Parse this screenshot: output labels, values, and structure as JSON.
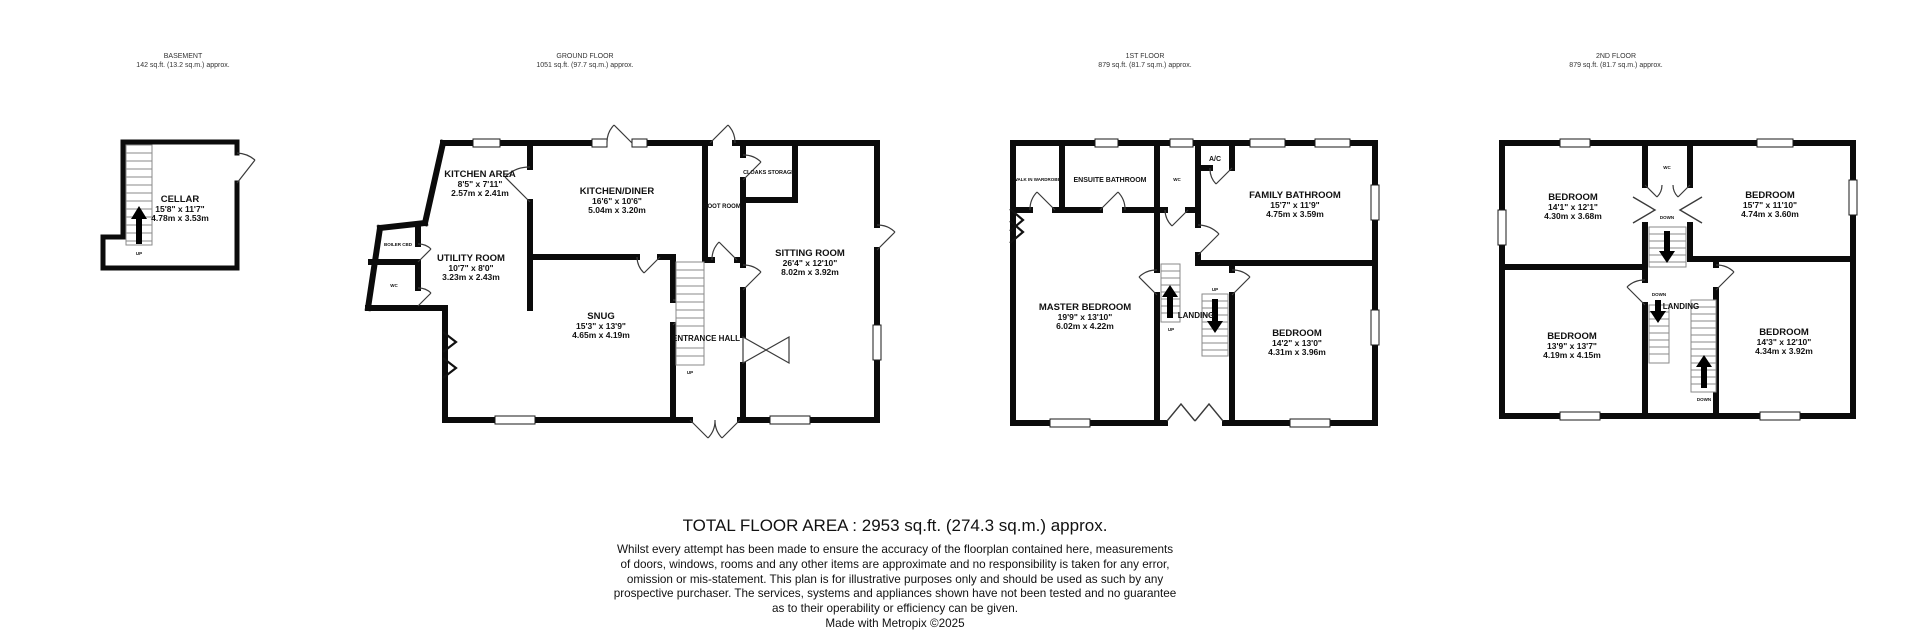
{
  "colors": {
    "walls": "#0b0b0b",
    "text": "#111111",
    "background": "#ffffff"
  },
  "floors": {
    "basement": {
      "label": "BASEMENT",
      "area": "142 sq.ft. (13.2 sq.m.) approx.",
      "rooms": {
        "cellar": {
          "name": "CELLAR",
          "imperial": "15'8\" x 11'7\"",
          "metric": "4.78m x 3.53m"
        }
      },
      "labels": {
        "up": "UP"
      }
    },
    "ground": {
      "label": "GROUND FLOOR",
      "area": "1051 sq.ft. (97.7 sq.m.) approx.",
      "rooms": {
        "kitchen_area": {
          "name": "KITCHEN AREA",
          "imperial": "8'5\" x 7'11\"",
          "metric": "2.57m x 2.41m"
        },
        "kitchen_diner": {
          "name": "KITCHEN/DINER",
          "imperial": "16'6\" x 10'6\"",
          "metric": "5.04m x 3.20m"
        },
        "utility": {
          "name": "UTILITY ROOM",
          "imperial": "10'7\" x 8'0\"",
          "metric": "3.23m x 2.43m"
        },
        "snug": {
          "name": "SNUG",
          "imperial": "15'3\" x 13'9\"",
          "metric": "4.65m x 4.19m"
        },
        "sitting": {
          "name": "SITTING ROOM",
          "imperial": "26'4\" x 12'10\"",
          "metric": "8.02m x 3.92m"
        }
      },
      "labels": {
        "boiler": "BOILER CBD",
        "wc": "WC",
        "boot": "BOOT ROOM",
        "cloaks": "CLOAKS STORAGE",
        "hall": "ENTRANCE HALL",
        "up": "UP"
      }
    },
    "first": {
      "label": "1ST FLOOR",
      "area": "879 sq.ft. (81.7 sq.m.) approx.",
      "rooms": {
        "family_bath": {
          "name": "FAMILY BATHROOM",
          "imperial": "15'7\" x 11'9\"",
          "metric": "4.75m x 3.59m"
        },
        "master": {
          "name": "MASTER BEDROOM",
          "imperial": "19'9\" x 13'10\"",
          "metric": "6.02m x 4.22m"
        },
        "bedroom": {
          "name": "BEDROOM",
          "imperial": "14'2\" x 13'0\"",
          "metric": "4.31m x 3.96m"
        }
      },
      "labels": {
        "wardrobe": "WALK IN WARDROBE",
        "ensuite": "ENSUITE BATHROOM",
        "wc": "WC",
        "ac": "A/C",
        "landing": "LANDING",
        "up": "UP"
      }
    },
    "second": {
      "label": "2ND FLOOR",
      "area": "879 sq.ft. (81.7 sq.m.) approx.",
      "rooms": {
        "bedroom_front_left": {
          "name": "BEDROOM",
          "imperial": "14'1\" x 12'1\"",
          "metric": "4.30m x 3.68m"
        },
        "bedroom_front_right": {
          "name": "BEDROOM",
          "imperial": "15'7\" x 11'10\"",
          "metric": "4.74m x 3.60m"
        },
        "bedroom_back_left": {
          "name": "BEDROOM",
          "imperial": "13'9\" x 13'7\"",
          "metric": "4.19m x 4.15m"
        },
        "bedroom_back_right": {
          "name": "BEDROOM",
          "imperial": "14'3\" x 12'10\"",
          "metric": "4.34m x 3.92m"
        }
      },
      "labels": {
        "wc": "WC",
        "landing": "LANDING",
        "down": "DOWN"
      }
    }
  },
  "footer": {
    "total": "TOTAL FLOOR AREA : 2953 sq.ft. (274.3 sq.m.) approx.",
    "lines": [
      "Whilst every attempt has been made to ensure the accuracy of the floorplan contained here, measurements",
      "of doors, windows, rooms and any other items are approximate and no responsibility is taken for any error,",
      "omission or mis-statement. This plan is for illustrative purposes only and should be used as such by any",
      "prospective purchaser. The services, systems and appliances shown have not been tested and no guarantee",
      "as to their operability or efficiency can be given."
    ],
    "credit": "Made with Metropix ©2025"
  }
}
